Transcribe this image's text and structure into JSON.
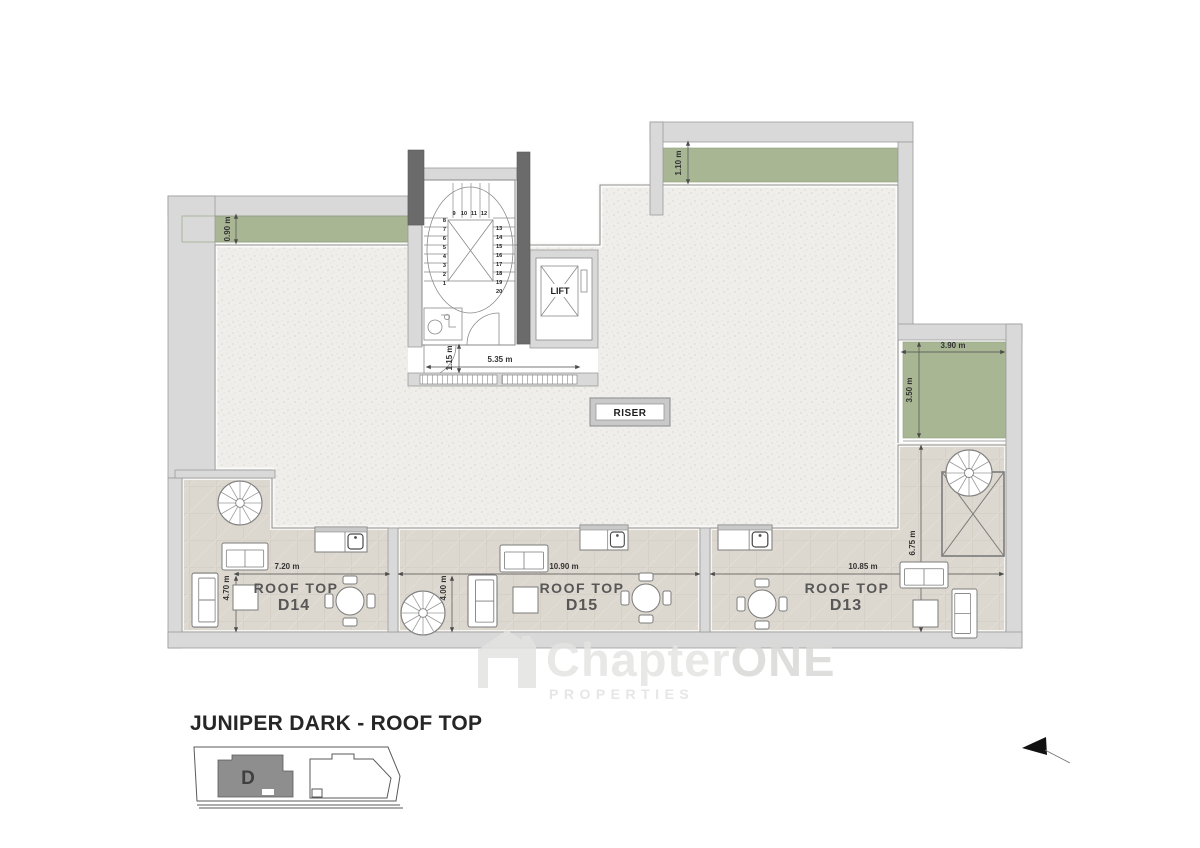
{
  "colors": {
    "planter_green": "#a8b694",
    "wall_light": "#d9d9d9",
    "wall_dark": "#6b6b6b",
    "terrace_tile": "#ddd8cf",
    "roof_gravel": "#efeeea",
    "line_gray": "#8f8f8f",
    "label_gray": "#575757"
  },
  "plan": {
    "core": {
      "lift": "LIFT",
      "riser": "RISER",
      "stair_left": [
        "8",
        "7",
        "6",
        "5",
        "4",
        "3",
        "2",
        "1"
      ],
      "stair_top": [
        "9",
        "10",
        "11",
        "12"
      ],
      "stair_right": [
        "13",
        "14",
        "15",
        "16",
        "17",
        "18",
        "19",
        "20"
      ]
    },
    "dims": {
      "planter_top_left": "0.90 m",
      "planter_top_right": "1.10 m",
      "planter_right_width": "3.90 m",
      "planter_right_height": "3.50 m",
      "core_width": "5.35 m",
      "core_door": "1.15 m",
      "d14_width": "7.20 m",
      "d14_depth": "4.70 m",
      "d15_width": "10.90 m",
      "d15_depth": "4.00 m",
      "d13_width": "10.85 m",
      "d13_depth": "6.75 m"
    },
    "terraces": [
      {
        "label": "ROOF TOP",
        "unit": "D14"
      },
      {
        "label": "ROOF TOP",
        "unit": "D15"
      },
      {
        "label": "ROOF TOP",
        "unit": "D13"
      }
    ]
  },
  "watermark": {
    "brand_a": "Chapter",
    "brand_b": "ONE",
    "tagline": "PROPERTIES"
  },
  "footer": {
    "title": "JUNIPER DARK - ROOF TOP",
    "keyplan_unit": "D"
  }
}
